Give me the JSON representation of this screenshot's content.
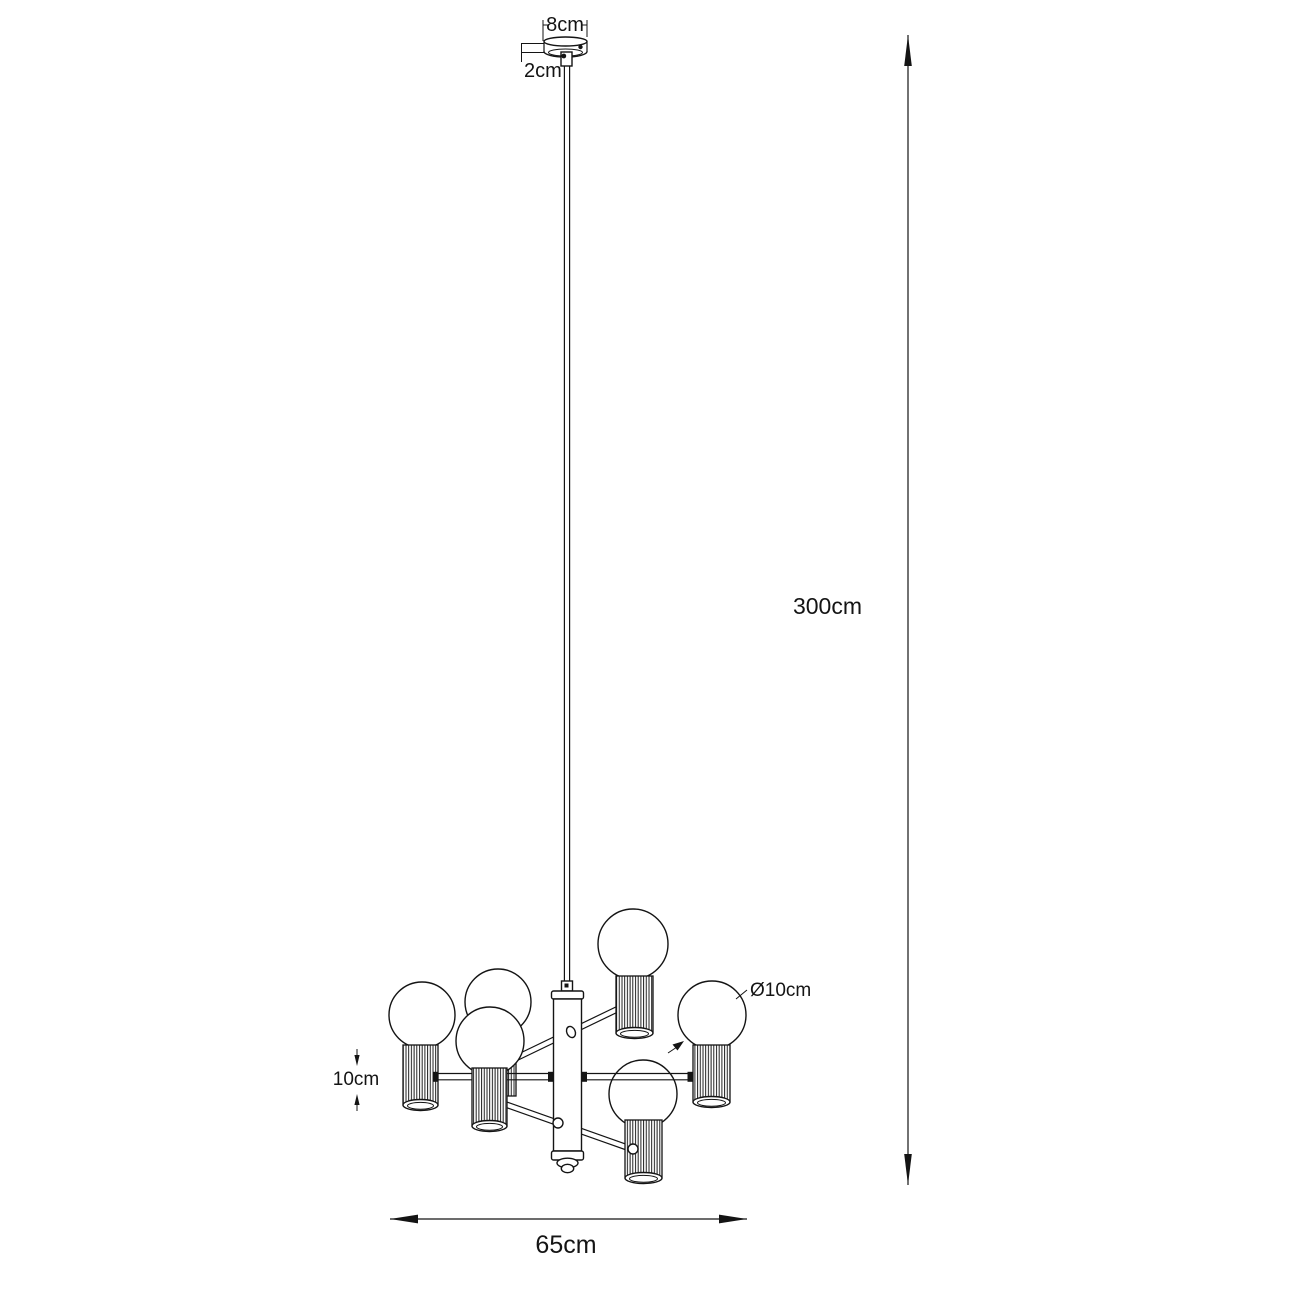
{
  "page": {
    "background": "#ffffff",
    "line_color": "#141414"
  },
  "diagram": {
    "kind": "pendant-lamp-dimension-drawing",
    "bulb_count": 6,
    "labels": {
      "canopy_width": "8cm",
      "canopy_height": "2cm",
      "suspension_height": "300cm",
      "bulb_diameter": "Ø10cm",
      "shade_height": "10cm",
      "fixture_width": "65cm"
    }
  }
}
